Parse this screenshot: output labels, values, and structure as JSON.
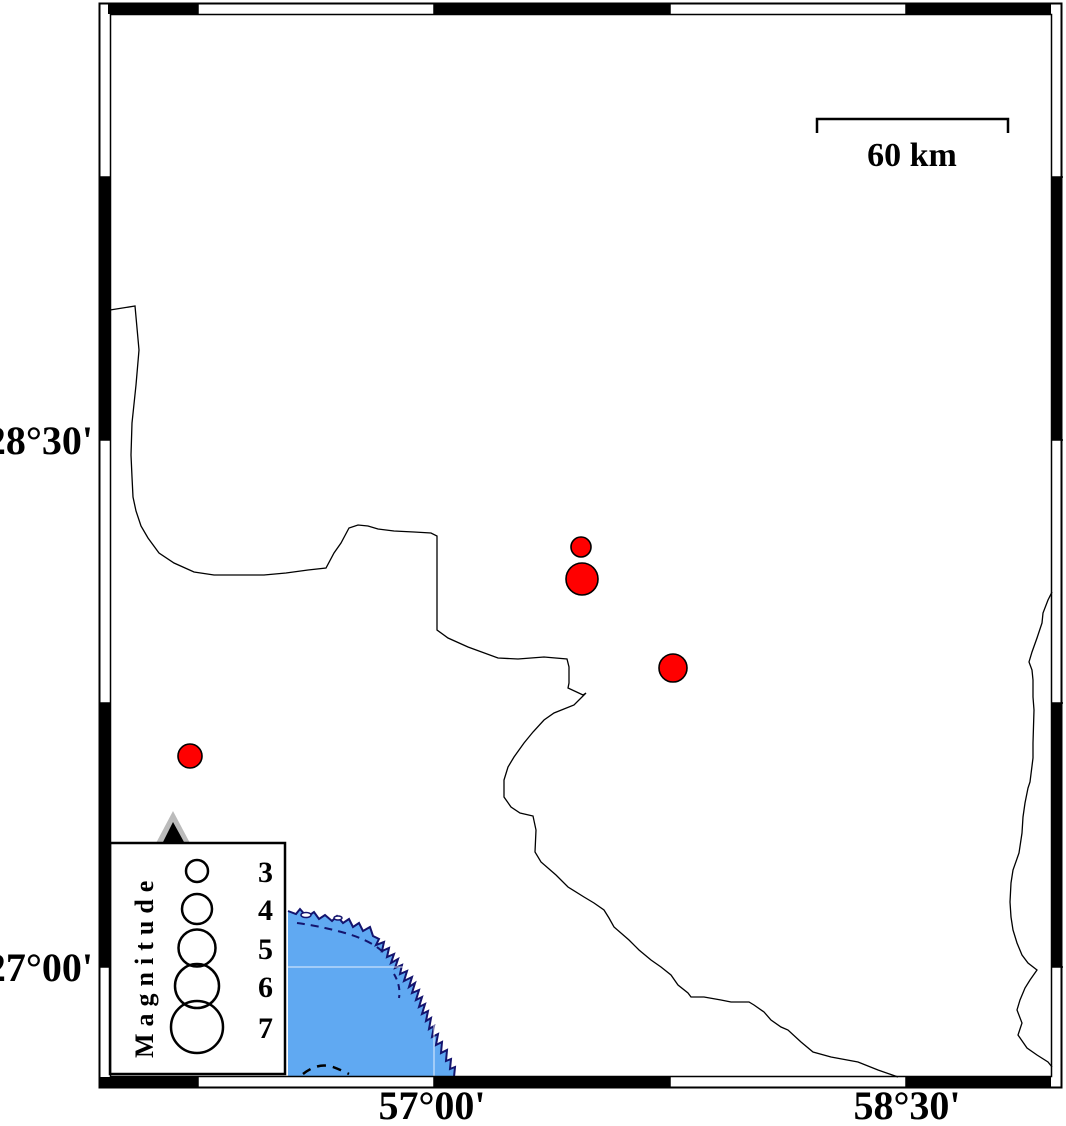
{
  "colors": {
    "background": "#ffffff",
    "frame": "#000000",
    "water": "#60a9f2",
    "coast": "#14146e",
    "border_line": "#000000",
    "epicenter_fill": "#ff0000",
    "epicenter_stroke": "#000000",
    "station_outer": "#bbbbbb",
    "station_inner": "#000000"
  },
  "axis_labels": {
    "latitude": [
      {
        "label": "28°30'",
        "y": 440
      },
      {
        "label": "27°00'",
        "y": 967
      }
    ],
    "longitude": [
      {
        "label": "57°00'",
        "x": 432
      },
      {
        "label": "58°30'",
        "x": 907
      }
    ]
  },
  "scale_bar": {
    "label": "60 km"
  },
  "legend": {
    "title": "Magnitude",
    "circle_cx": 197,
    "label_x": 258,
    "entries": [
      {
        "magnitude": "3",
        "radius": 11,
        "cy": 871
      },
      {
        "magnitude": "4",
        "radius": 15,
        "cy": 909
      },
      {
        "magnitude": "5",
        "radius": 18.5,
        "cy": 948
      },
      {
        "magnitude": "6",
        "radius": 22,
        "cy": 986
      },
      {
        "magnitude": "7",
        "radius": 26,
        "cy": 1027
      }
    ]
  },
  "epicenters": [
    {
      "x": 581,
      "y": 547,
      "r": 10
    },
    {
      "x": 582,
      "y": 579,
      "r": 16
    },
    {
      "x": 673,
      "y": 668,
      "r": 14
    },
    {
      "x": 190,
      "y": 756,
      "r": 12
    }
  ],
  "station": {
    "type": "seismic-station-triangle",
    "x": 173,
    "y": 830
  }
}
